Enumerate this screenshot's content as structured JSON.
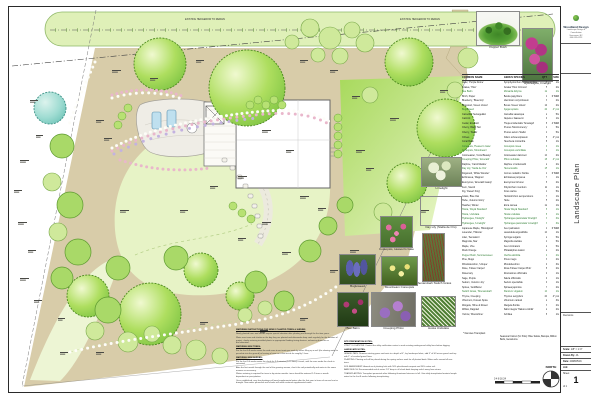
{
  "colors": {
    "accent_green": "#7cc342",
    "bed_tan": "#d8cca9",
    "teal_tree": "#7fcfc0",
    "highlight_row": "#2e7d32"
  },
  "plan": {
    "hedge_label": "EXISTING HEDGEROW TO REMAIN",
    "north_label": "NORTH",
    "scalebar_text": "0   4   8   16   24"
  },
  "photos_top": [
    {
      "caption": "Pepper Bush"
    },
    {
      "caption": "Hydrangea, Firelight"
    }
  ],
  "photos_mid": [
    {
      "caption": "Limelight"
    },
    {
      "caption": "Day Lily (Stella de Oro)"
    },
    {
      "caption": "Coreopsis, Heaven's Gate"
    },
    {
      "caption": "Shenandoah Switch Grass"
    },
    {
      "caption": "Bugleweed"
    },
    {
      "caption": "Moonbeam Coreopsis"
    },
    {
      "caption": "Bee Balm"
    },
    {
      "caption": "Creeping Phlox"
    },
    {
      "caption": "Hosta Undulata"
    }
  ],
  "schedule": {
    "headers": {
      "common": "COMMON NAME",
      "genus": "GENUS SPECIES",
      "qty": "QTY",
      "size": "SIZE"
    },
    "legend": "* Denotes Transplant",
    "pots_note": "Seasonal Colour (for Pots): Blue Salvia, Bacopa, Million Bells, Geraniums.",
    "rows": [
      {
        "c": "Aster, 'Purple Dome'",
        "g": "Symphyotrichum novae-angliae",
        "q": "3",
        "s": "1G"
      },
      {
        "c": "Azalea, 'Hino'",
        "g": "Azalea 'Hino Crimson'",
        "q": "5",
        "s": "2G"
      },
      {
        "c": "Bee Balm",
        "g": "Monarda didyma",
        "q": "12",
        "s": "1G",
        "hl": true
      },
      {
        "c": "Birch, Paper",
        "g": "Betula papyrifera",
        "q": "1",
        "s": "6' B&B"
      },
      {
        "c": "Blueberry, 'Bluecrop'",
        "g": "Vaccinium corymbosum",
        "q": "3",
        "s": "2G"
      },
      {
        "c": "Boxwood, 'Green Velvet'",
        "g": "Buxus 'Green Velvet'",
        "q": "14",
        "s": "2G"
      },
      {
        "c": "Bugleweed",
        "g": "Ajuga reptans",
        "q": "24",
        "s": "4\" pot",
        "hl": true
      },
      {
        "c": "Camellia, 'Setsugekka'",
        "g": "Camellia sasanqua",
        "q": "2",
        "s": "5G"
      },
      {
        "c": "Catmint",
        "g": "Nepeta x faassenii",
        "q": "9",
        "s": "1G"
      },
      {
        "c": "Cedar, Emerald",
        "g": "Thuja occidentalis 'Smaragd'",
        "q": "8",
        "s": "4' B&B"
      },
      {
        "c": "Cherry, Black Tart",
        "g": "Prunus 'Montmorency'",
        "q": "1",
        "s": "5G"
      },
      {
        "c": "Cherry, 'Stella'",
        "g": "Prunus avium 'Stella'",
        "q": "1",
        "s": "5G"
      },
      {
        "c": "Chives",
        "g": "Allium schoenoprasum",
        "q": "6",
        "s": "4\" pot"
      },
      {
        "c": "Coral Bells",
        "g": "Heuchera micrantha",
        "q": "8",
        "s": "1G"
      },
      {
        "c": "Coreopsis, 'Heaven's Gate'",
        "g": "Coreopsis rosea",
        "q": "9",
        "s": "1G",
        "hl": true
      },
      {
        "c": "Coreopsis, 'Moonbeam'",
        "g": "Coreopsis verticillata",
        "q": "9",
        "s": "1G",
        "hl": true
      },
      {
        "c": "Cotoneaster, 'Coral Beauty'",
        "g": "Cotoneaster dammeri",
        "q": "10",
        "s": "2G"
      },
      {
        "c": "Creeping Phlox, 'Emerald'",
        "g": "Phlox subulata",
        "q": "18",
        "s": "4\" pot",
        "hl": true
      },
      {
        "c": "Daphne, 'Carol Mackie'",
        "g": "Daphne x burkwoodii",
        "q": "2",
        "s": "2G"
      },
      {
        "c": "Day Lily, 'Stella de Oro'",
        "g": "Hemerocallis",
        "q": "15",
        "s": "1G",
        "hl": true
      },
      {
        "c": "Dogwood, 'White Wonder'",
        "g": "Cornus nuttallii x florida",
        "q": "1",
        "s": "6' B&B"
      },
      {
        "c": "Echinacea, 'Magnus'",
        "g": "Echinacea purpurea",
        "q": "7",
        "s": "1G"
      },
      {
        "c": "Euonymus, 'Emerald Gaiety'",
        "g": "Euonymus fortunei",
        "q": "6",
        "s": "2G"
      },
      {
        "c": "Fern, Sword",
        "g": "Polystichum munitum",
        "q": "11",
        "s": "1G"
      },
      {
        "c": "Fig, 'Desert King'",
        "g": "Ficus carica",
        "q": "1",
        "s": "5G"
      },
      {
        "c": "Grass, Blue Oat",
        "g": "Helictotrichon sempervirens",
        "q": "7",
        "s": "1G"
      },
      {
        "c": "Hebe, 'Autumn Glory'",
        "g": "Hebe",
        "q": "5",
        "s": "2G"
      },
      {
        "c": "Heather, Winter",
        "g": "Erica carnea",
        "q": "12",
        "s": "1G"
      },
      {
        "c": "Hosta, 'Royal Standard'",
        "g": "Hosta 'Royal Standard'",
        "q": "6",
        "s": "1G",
        "hl": true
      },
      {
        "c": "Hosta, Undulata",
        "g": "Hosta undulata",
        "q": "8",
        "s": "1G",
        "hl": true
      },
      {
        "c": "Hydrangea, 'Firelight'",
        "g": "Hydrangea paniculata 'Firelight'",
        "q": "3",
        "s": "3G",
        "hl": true
      },
      {
        "c": "Hydrangea, 'Limelight'",
        "g": "Hydrangea paniculata 'Limelight'",
        "q": "3",
        "s": "3G",
        "hl": true
      },
      {
        "c": "Japanese Maple, 'Bloodgood'",
        "g": "Acer palmatum",
        "q": "1",
        "s": "6' B&B"
      },
      {
        "c": "Lavender, 'Hidcote'",
        "g": "Lavandula angustifolia",
        "q": "10",
        "s": "1G"
      },
      {
        "c": "Lilac, 'Sensation'",
        "g": "Syringa vulgaris",
        "q": "2",
        "s": "5G"
      },
      {
        "c": "Magnolia, Star",
        "g": "Magnolia stellata",
        "q": "1",
        "s": "5G"
      },
      {
        "c": "Maple, Vine",
        "g": "Acer circinatum",
        "q": "2",
        "s": "5G"
      },
      {
        "c": "Mock Orange",
        "g": "Philadelphus lewisii",
        "q": "2",
        "s": "2G"
      },
      {
        "c": "Pepper Bush, Summersweet",
        "g": "Clethra alnifolia",
        "q": "4",
        "s": "2G",
        "hl": true
      },
      {
        "c": "Pine, Mugo",
        "g": "Pinus mugo",
        "q": "3",
        "s": "2G"
      },
      {
        "c": "Rhododendron, 'Unique'",
        "g": "Rhododendron",
        "q": "4",
        "s": "3G"
      },
      {
        "c": "Rose, 'Flower Carpet'",
        "g": "Rosa 'Flower Carpet Pink'",
        "q": "8",
        "s": "2G"
      },
      {
        "c": "Rosemary",
        "g": "Rosmarinus officinalis",
        "q": "4",
        "s": "1G"
      },
      {
        "c": "Sage, Purple",
        "g": "Salvia officinalis",
        "q": "4",
        "s": "1G"
      },
      {
        "c": "Sedum, 'Autumn Joy'",
        "g": "Sedum spectabile",
        "q": "9",
        "s": "1G"
      },
      {
        "c": "Spirea, 'Goldflame'",
        "g": "Spiraea japonica",
        "q": "7",
        "s": "2G"
      },
      {
        "c": "Switch Grass, 'Shenandoah'",
        "g": "Panicum virgatum",
        "q": "10",
        "s": "1G",
        "hl": true
      },
      {
        "c": "Thyme, Creeping",
        "g": "Thymus serpyllum",
        "q": "20",
        "s": "4\" pot"
      },
      {
        "c": "Viburnum, Korean Spice",
        "g": "Viburnum carlesii",
        "q": "2",
        "s": "3G"
      },
      {
        "c": "Weigela, 'Wine & Roses'",
        "g": "Weigela florida",
        "q": "3",
        "s": "2G"
      },
      {
        "c": "Willow, Dappled",
        "g": "Salix integra 'Hakuro-nishiki'",
        "q": "2",
        "s": "2G"
      },
      {
        "c": "Yarrow, 'Moonshine'",
        "g": "Achillea",
        "q": "8",
        "s": "1G"
      }
    ]
  },
  "notes_left": {
    "lines": [
      {
        "h": true,
        "t": "WATERING INSTRUCTIONS FOR NEWLY PLANTED TREES & SHRUBS"
      },
      {
        "t": "Newly planted trees and shrubs require special attention after planting and through the first two years."
      },
      {
        "t": "Water new trees and shrubs on the day they are planted and afterwards deep soak regularly for the duration of project, slowly watering installed plants in appropriate flooding timing devices, enhancing branches or discolouration."
      },
      {
        "h": true,
        "t": "WATERING NEW TREES:"
      },
      {
        "t": "For the first 6-8 weeks water the wide area to wet roots per week by either filling up a well (the slowing water to percolate into the ground) or leaving a hose on a slow trickle for roughly 1 hour."
      },
      {
        "h": true,
        "t": "WATERING NEW SHRUBS:"
      },
      {
        "t": "For the first 3-4 weeks water the shrub for 3-5 minutes (5-10 litres) a week, until the area under the shrub is saturated."
      },
      {
        "t": "After the first month through the end of the growing season, check the soil periodically and water in the same manner as necessary."
      },
      {
        "t": "Winter watering is required for trees in dry winter months: trees should be watered 1-2 times a month dependent on precipitation."
      },
      {
        "t": "Once established, very few plantings will need supplemental water after the first year in times of excess heat or drought. Non-native perennials and shrubs will need continual supplemental water."
      }
    ]
  },
  "notes_right": {
    "lines": [
      {
        "h": true,
        "t": "SITE PREPARATION NOTES:"
      },
      {
        "t": "UTILITY LOCATIONS: Contact the utility notification center to mark existing underground utility lines before digging."
      },
      {
        "h": true,
        "t": "LANDSCAPE NOTES:"
      },
      {
        "t": "GRAVEL PATH: Remove existing grass and roots to a depth of 4\", lay landscape fabric, add 3\" of 3/4 minus gravel and top with 1\" of crushed gravel fines."
      },
      {
        "t": "PLANTING: Planting soil will be placed during the spring surface work for all planted beds. Water wells around all new trees."
      },
      {
        "t": "SOIL AMENDMENT: Amend each planting hole with 50% plant-based compost and 50% native soil."
      },
      {
        "t": "BARK MULCH: Recommended mulch varies 2-3\" deep in all shrub beds keeping mulch away from stems."
      },
      {
        "t": "TRANSPLANTING: Transplant perennials after following threatened stresses in fall. Give daily transplanted material ample water for the first 8 weeks following transplanting."
      }
    ]
  },
  "titleblock": {
    "company_name": "Woodland Design",
    "company_line1": "Landscape Design & Consultation",
    "company_line2": "Vancouver, BC",
    "company_line3": "604-555-0123",
    "vertical_title": "Landscape Plan",
    "revisions_label": "Revisions",
    "scale_label": "Scale:",
    "scale_value": "1/8\" = 1'-0\"",
    "drawn_label": "Drawn By:",
    "drawn_value": "JA",
    "date_label": "Date:",
    "date_value": "2008/05/16",
    "job_label": "Job:",
    "sheet_label": "Sheet",
    "sheet_number": "1",
    "of_label": "of 1"
  }
}
